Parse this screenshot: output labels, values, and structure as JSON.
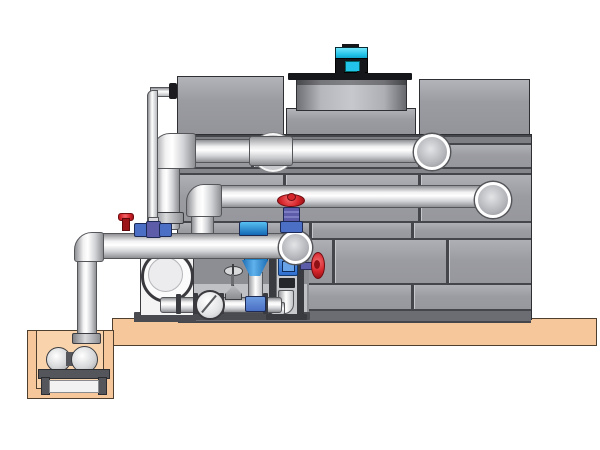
{
  "diagram": {
    "type": "technical-illustration",
    "subject": "closed-circuit cooling tower with pump skid, sump pit and piping",
    "title": "",
    "visible_text": [],
    "components": [
      {
        "name": "cooling-tower-tank",
        "description": "large gray paneled tower casing with staggered panel seams"
      },
      {
        "name": "fan-shroud",
        "description": "cylindrical fan cowl with dark top plate on tower roof"
      },
      {
        "name": "fan-motor",
        "description": "cyan and black electric motor on top of fan shroud"
      },
      {
        "name": "upper-left-casing",
        "description": "upper left gray casing box"
      },
      {
        "name": "upper-right-casing",
        "description": "upper right gray casing box"
      },
      {
        "name": "upper-distribution-pipe",
        "description": "horizontal spray water pipe entering tower, elbow down at right"
      },
      {
        "name": "middle-return-pipe",
        "description": "second horizontal pipe entering tower, elbow down at right"
      },
      {
        "name": "wall-coupling",
        "description": "pipe sleeve and round wall penetration plate on upper pipe"
      },
      {
        "name": "suction-header-pipe",
        "description": "large horizontal suction header on pump skid"
      },
      {
        "name": "equalizer-thin-pipe",
        "description": "small-bore vertical line from tower top-left down to header fittings"
      },
      {
        "name": "riser-pipe-1",
        "description": "vertical riser feeding upper distribution pipe"
      },
      {
        "name": "riser-pipe-2",
        "description": "vertical riser feeding middle return pipe"
      },
      {
        "name": "centrifugal-pump",
        "description": "white pump casing with large circular inlet"
      },
      {
        "name": "inline-vertical-pump",
        "description": "blue-top vertical inline pump hanging under suction header"
      },
      {
        "name": "gate-valve-red",
        "description": "red handwheel gate valve on header end"
      },
      {
        "name": "side-valve-red",
        "description": "red handwheel valve facing right on instrument stand"
      },
      {
        "name": "instrument-stand",
        "description": "frame stand with blue control screen and internal elbow"
      },
      {
        "name": "check-valve",
        "description": "wafer check valve disc in bottom drain line"
      },
      {
        "name": "globe-valve-small",
        "description": "small globe valve with spoked handwheel on bottom line"
      },
      {
        "name": "dosing-fittings",
        "description": "small red and blue chemical dosing valves on header top"
      },
      {
        "name": "bottom-drain-pipe",
        "description": "small-bore bottom pipework with flanges"
      },
      {
        "name": "concrete-slab",
        "description": "tan concrete foundation slab"
      },
      {
        "name": "sump-pit",
        "description": "tan below-grade sump basin"
      },
      {
        "name": "sump-pump",
        "description": "horizontal pump set on stand inside sump pit"
      },
      {
        "name": "sump-riser-pipe",
        "description": "vertical pipe from sump pump up to suction header"
      }
    ]
  },
  "colors": {
    "background": "#ffffff",
    "tank_panel": "#9b9ca2",
    "tank_seam": "#45464b",
    "tank_border": "#2e2f33",
    "tank_shadow": "#8d8e93",
    "pipe_mid": "#d2d3d6",
    "pipe_dark": "#8f9094",
    "pipe_border": "#55565a",
    "slab": "#f5c79b",
    "slab_border": "#4e3f2e",
    "pit_inner": "#f8d3ab",
    "motor_cyan": "#23c4ea",
    "motor_dark": "#15161a",
    "valve_red": "#d6252b",
    "valve_blue": "#4a6fc4",
    "valve_purple": "#5c5ca8",
    "pump_body": "#f4f4f5",
    "frame_dark": "#3a3b40",
    "screen_blue": "#2f6fd0"
  }
}
